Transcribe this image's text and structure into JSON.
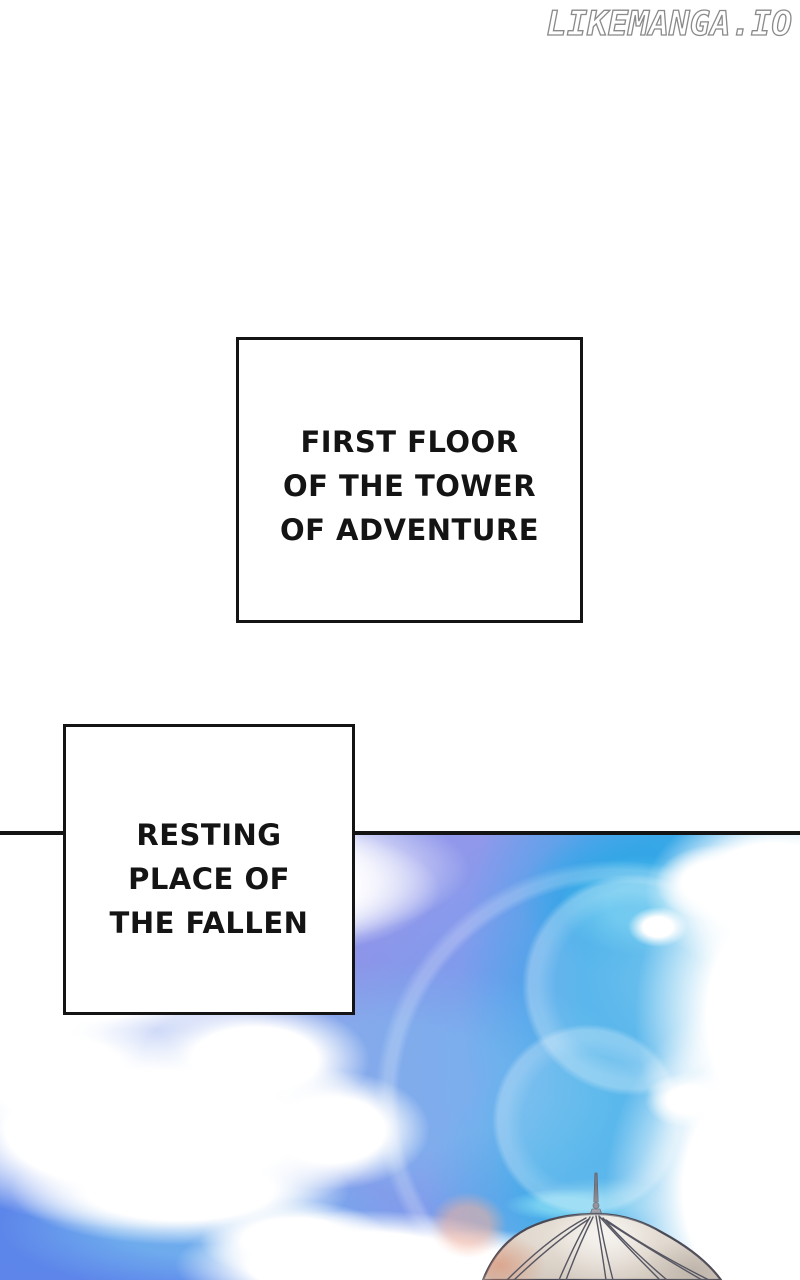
{
  "watermark": {
    "text": "LIKEMANGA.IO"
  },
  "captions": [
    {
      "id": "first-floor",
      "text": "FIRST FLOOR\nOF THE TOWER\nOF ADVENTURE"
    },
    {
      "id": "resting-place",
      "text": "RESTING\nPLACE OF\nTHE FALLEN"
    }
  ],
  "illustration": {
    "alt": "Bright daytime sky with white clouds; the pale ribbed top of a dome with a thin spire rises from the bottom edge",
    "theme": {
      "ink": "#141414",
      "paper": "#ffffff",
      "watermark_outline": "#8a8a8a",
      "sky_periwinkle": "#8a93e8",
      "sky_cornflower": "#5d85ea",
      "sky_azure": "#38a9e8",
      "sky_cyan_fringe": "#7fd0f0",
      "cloud_white": "#ffffff",
      "dome_fill": "#d9d0c6",
      "dome_outline": "#4a4a56",
      "dome_warm_tint": "#de8c6c"
    }
  }
}
